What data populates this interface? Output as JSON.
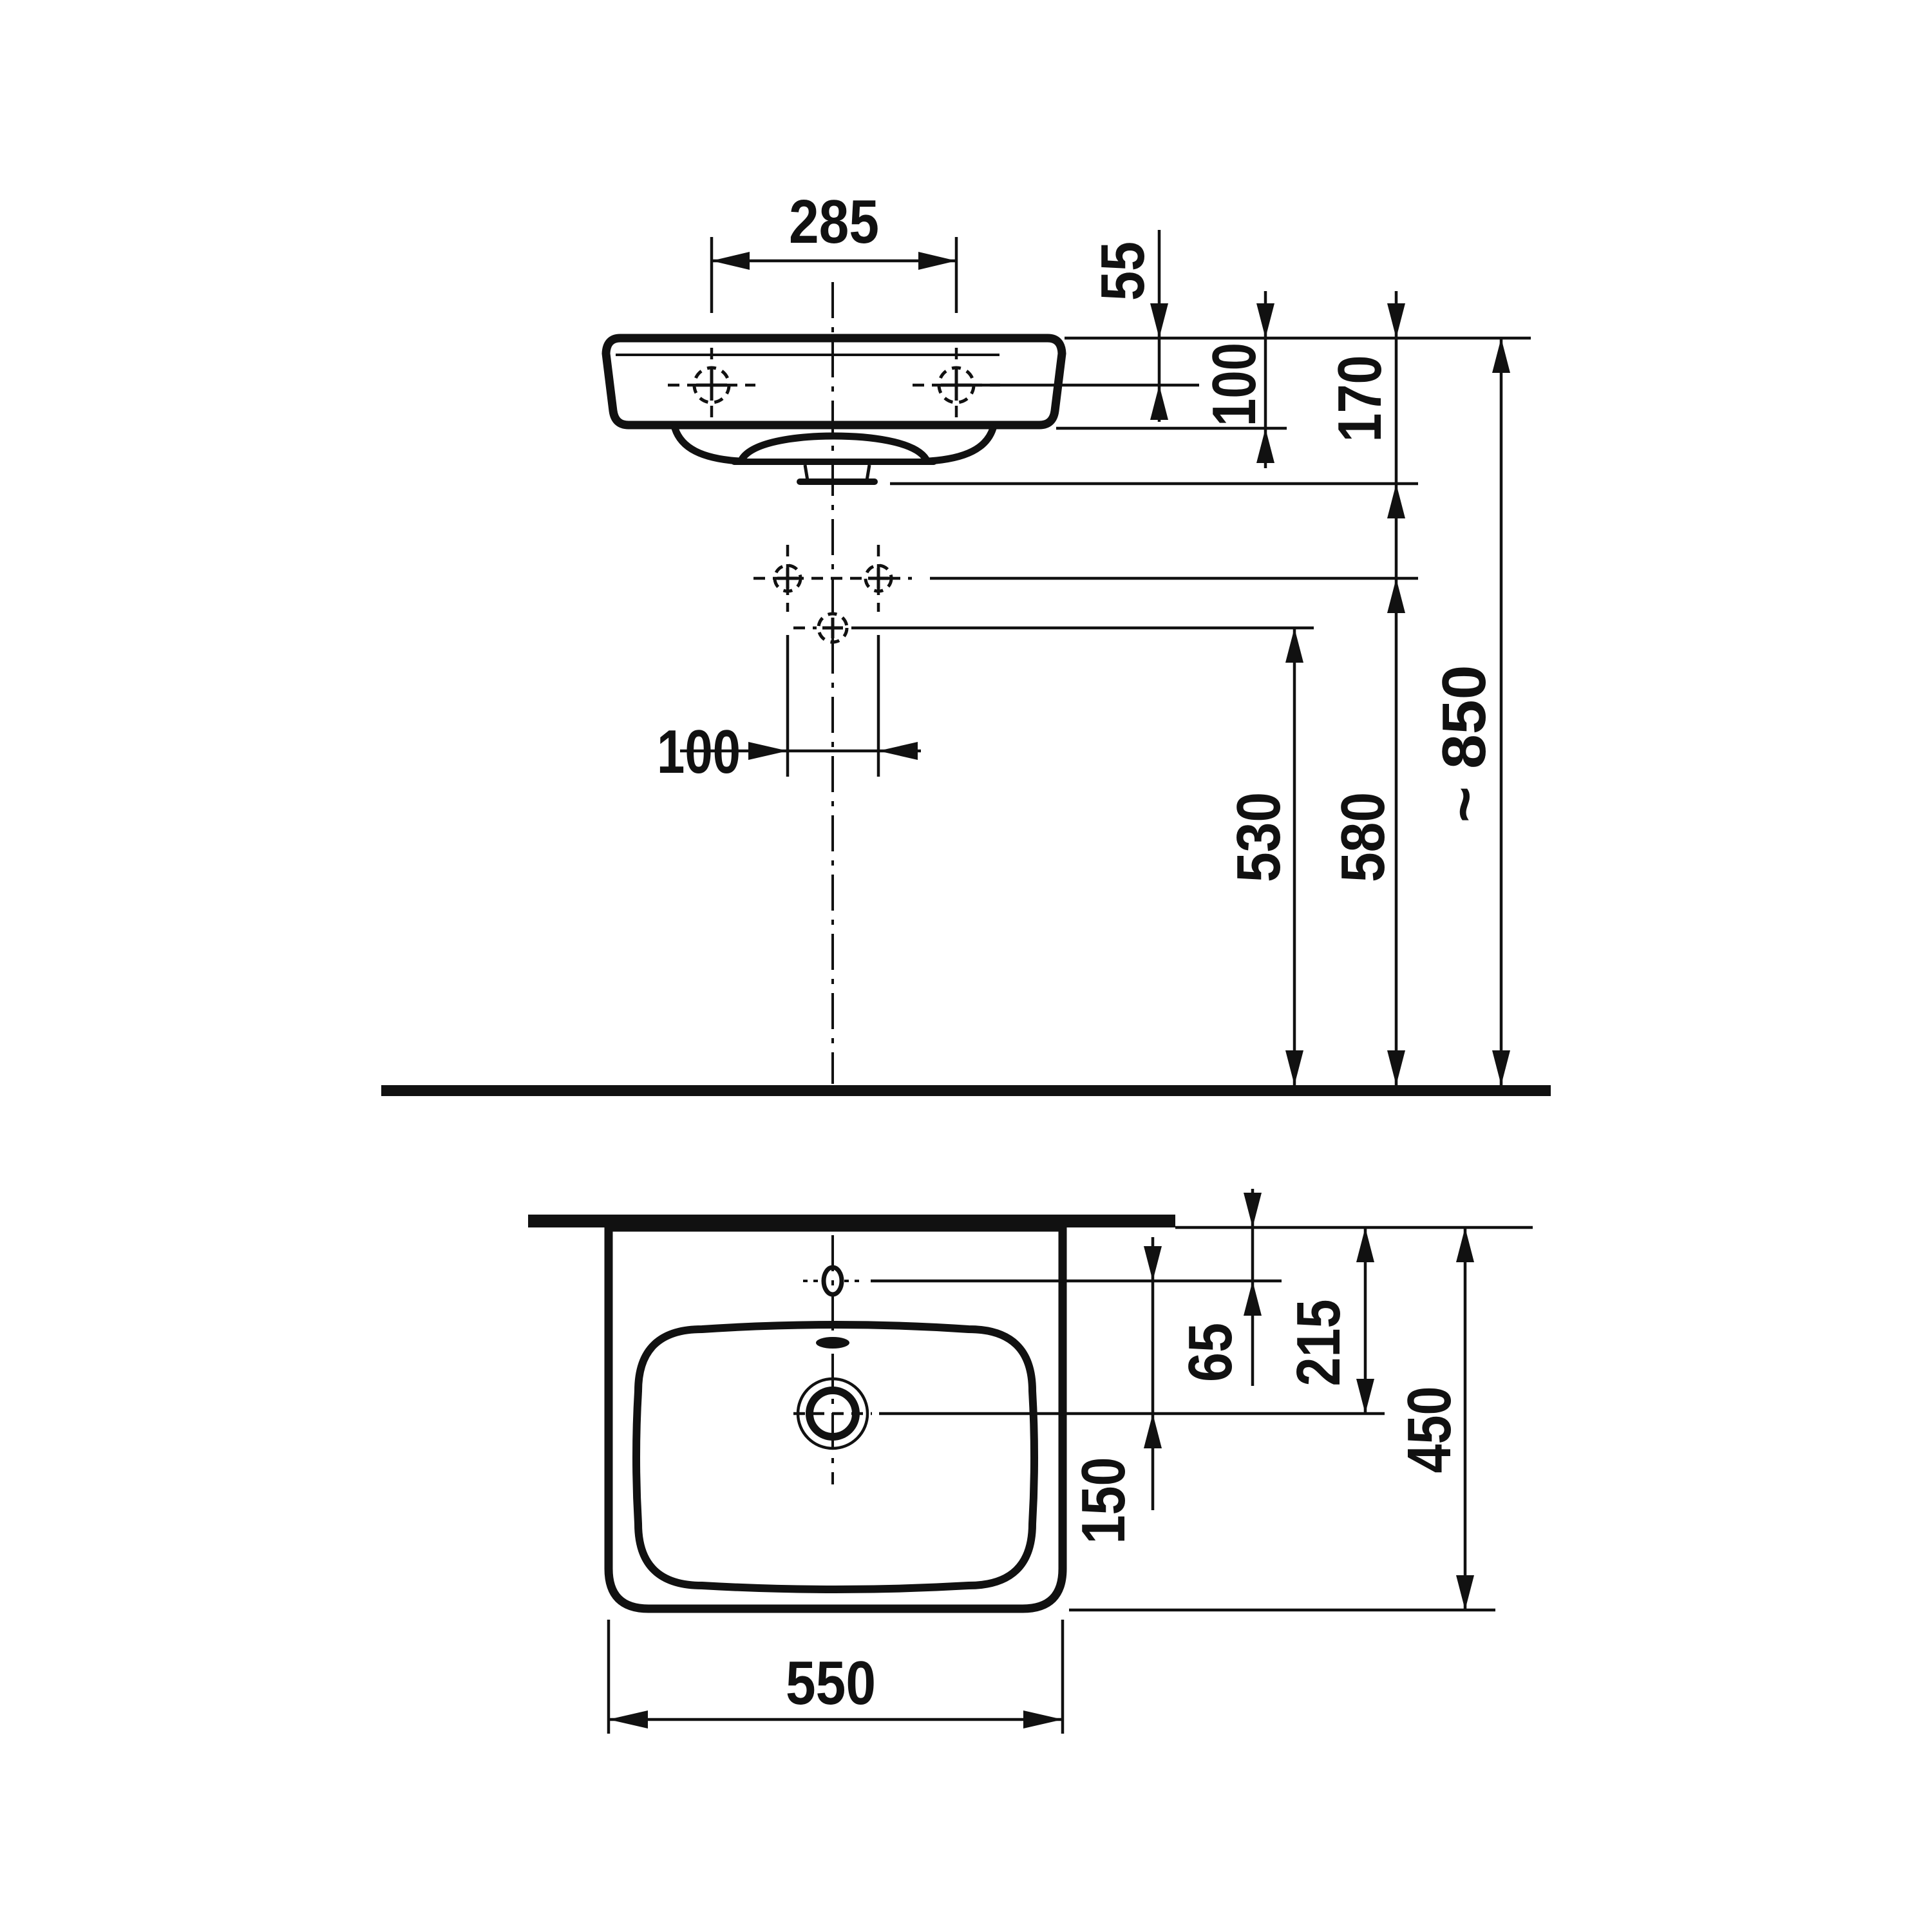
{
  "drawing": {
    "subject": "Wall-hung washbasin technical dimension drawing (front elevation and plan view)",
    "units": "mm",
    "line_color": "#111111",
    "background_color": "#ffffff",
    "front_view": {
      "dimensions": {
        "tap_hole_spacing": "285",
        "rim_to_mounting_holes": "55",
        "rim_to_body_bottom": "100",
        "rim_to_underside": "170",
        "supply_hole_spacing": "100",
        "floor_to_drain_outlet": "530",
        "floor_to_supply_holes": "580",
        "floor_to_rim": "~ 850"
      }
    },
    "plan_view": {
      "dimensions": {
        "wall_to_tap_hole": "65",
        "tap_hole_to_drain": "150",
        "wall_to_drain": "215",
        "basin_depth": "450",
        "basin_width": "550"
      }
    }
  }
}
